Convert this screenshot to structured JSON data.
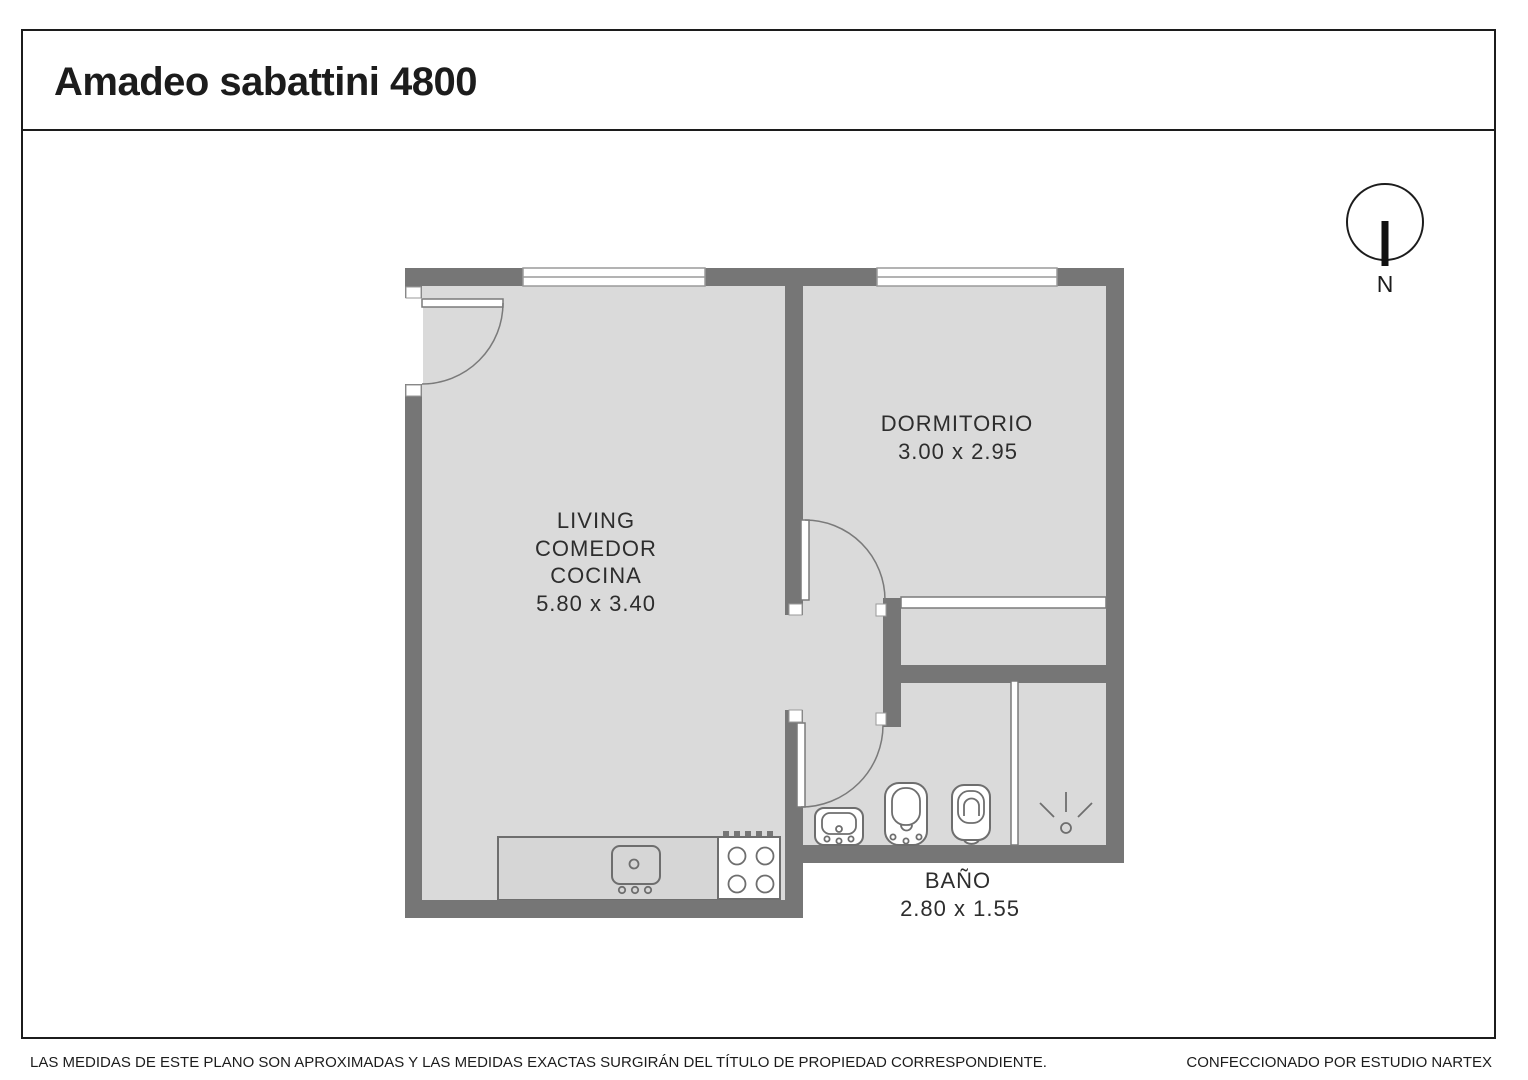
{
  "title": "Amadeo sabattini 4800",
  "rooms": {
    "living": {
      "lines": [
        "LIVING",
        "COMEDOR",
        "COCINA"
      ],
      "dims": "5.80 x 3.40"
    },
    "dormitorio": {
      "name": "DORMITORIO",
      "dims": "3.00 x 2.95"
    },
    "bano": {
      "name": "BAÑO",
      "dims": "2.80 x 1.55"
    }
  },
  "compass": {
    "label": "N"
  },
  "footer": {
    "disclaimer": "LAS MEDIDAS  DE ESTE PLANO SON APROXIMADAS Y LAS MEDIDAS EXACTAS SURGIRÁN DEL TÍTULO DE PROPIEDAD CORRESPONDIENTE.",
    "credit": "CONFECCIONADO POR ESTUDIO NARTEX"
  },
  "colors": {
    "wall": "#767676",
    "floor": "#dadada",
    "fixture_outline": "#6e6e6e",
    "window_line": "#9a9a9a",
    "frame_line": "#1c1c1c",
    "label_text": "#2d2d2d"
  }
}
